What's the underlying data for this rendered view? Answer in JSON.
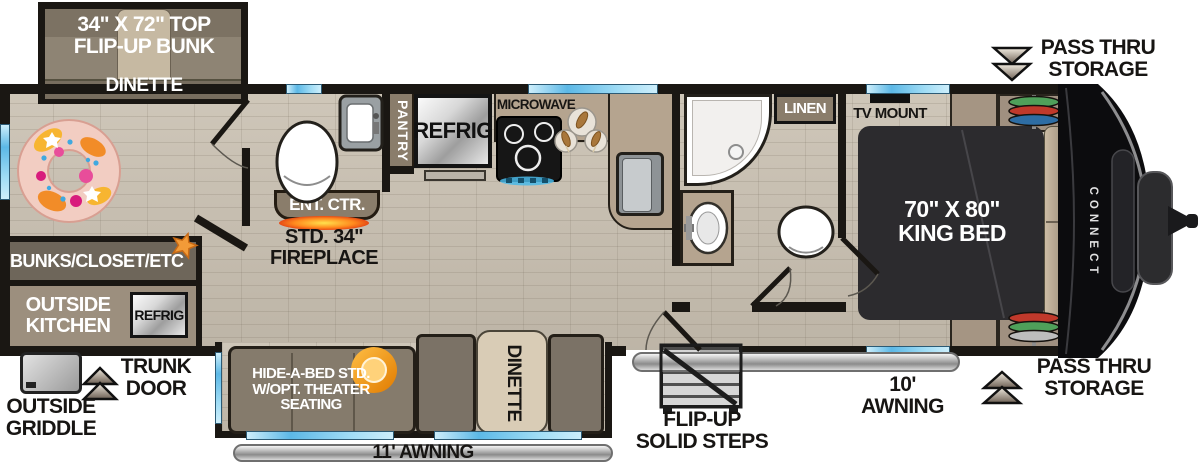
{
  "title": "Travel Trailer Floorplan",
  "brand": "CONNECT",
  "colors": {
    "wall": "#1a1713",
    "floor_wood": "#c9c0b1",
    "window_blue": "#5cb8e6",
    "band_dark": "#6e665a",
    "band_mid": "#9c8f7e",
    "cabinet_tan": "#8a7d6b",
    "counter_tan": "#b5a48f",
    "bed_dark": "#2c2b2e",
    "accent_orange": "#f29b38",
    "fireplace_orange": "#ff7a1a"
  },
  "labels": {
    "bunk": {
      "line1": "34\" X 72\" TOP",
      "line2": "FLIP-UP BUNK"
    },
    "dinette_front": "DINETTE",
    "pass_thru_top": {
      "line1": "PASS THRU",
      "line2": "STORAGE"
    },
    "pass_thru_bottom": {
      "line1": "PASS THRU",
      "line2": "STORAGE"
    },
    "linen": "LINEN",
    "tv_mount": "TV MOUNT",
    "king_bed": {
      "line1": "70\" X 80\"",
      "line2": "KING BED"
    },
    "microwave": "MICROWAVE",
    "refrig": "REFRIG",
    "pantry": "PANTRY",
    "ent_ctr": "ENT. CTR.",
    "fireplace": {
      "line1": "STD. 34\"",
      "line2": "FIREPLACE"
    },
    "bunks_closet": "BUNKS/CLOSET/ETC",
    "outside_kitchen": {
      "line1": "OUTSIDE",
      "line2": "KITCHEN"
    },
    "outside_refrig": "REFRIG",
    "trunk_door": {
      "line1": "TRUNK",
      "line2": "DOOR"
    },
    "outside_griddle": {
      "line1": "OUTSIDE",
      "line2": "GRIDDLE"
    },
    "hide_a_bed": {
      "line1": "HIDE-A-BED STD.",
      "line2": "W/OPT. THEATER",
      "line3": "SEATING"
    },
    "dinette_rear": "DINETTE",
    "awning_11": "11' AWNING",
    "awning_10": {
      "line1": "10'",
      "line2": "AWNING"
    },
    "steps": {
      "line1": "FLIP-UP",
      "line2": "SOLID STEPS"
    }
  }
}
